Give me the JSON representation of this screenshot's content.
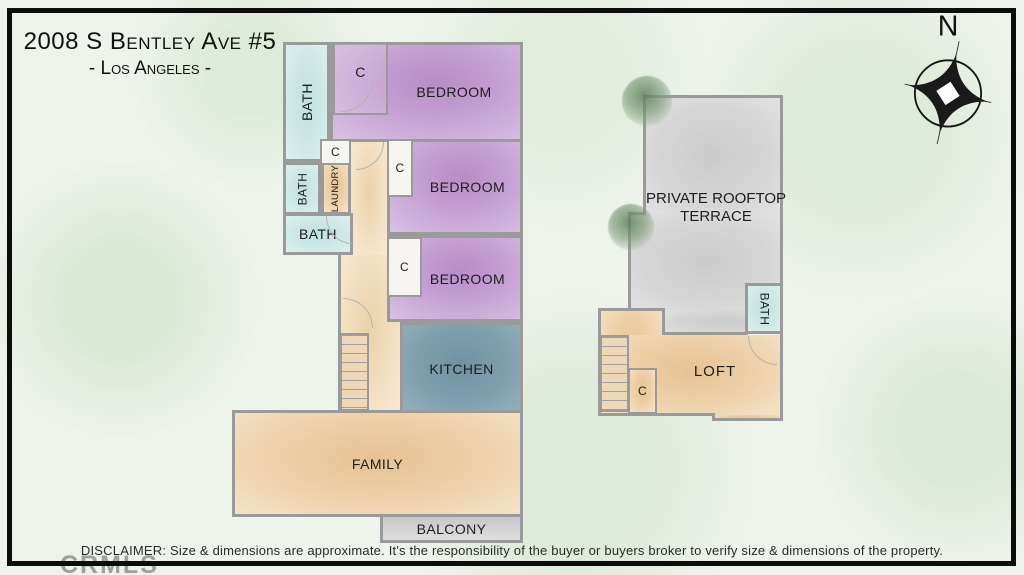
{
  "header": {
    "title": "2008 S Bentley Ave #5",
    "subtitle": "- Los Angeles -"
  },
  "compass": {
    "north_label": "N"
  },
  "plan_main": {
    "bath_top": "BATH",
    "closet_top": "C",
    "bedroom_1": "BEDROOM",
    "closet_hall": "C",
    "bath_mid": "BATH",
    "laundry": "LAUNDRY",
    "bedroom_2": "BEDROOM",
    "closet_bed2": "C",
    "bath_low": "BATH",
    "bedroom_3": "BEDROOM",
    "closet_bed3": "C",
    "kitchen": "KITCHEN",
    "family": "FAMILY",
    "balcony": "BALCONY"
  },
  "plan_upper": {
    "terrace": "PRIVATE ROOFTOP TERRACE",
    "bath": "BATH",
    "loft": "LOFT",
    "closet": "C"
  },
  "footer": {
    "disclaimer": "DISCLAIMER: Size & dimensions are approximate. It's the responsibility of the buyer or buyers broker to verify size & dimensions of the property."
  },
  "watermark": "CRMLS",
  "colors": {
    "bedroom": "#c7a4d4",
    "bath": "#c9e6e4",
    "living": "#ecca9e",
    "kitchen": "#7f9fae",
    "terrace": "#d6d6d6",
    "balcony": "#d8d8d8",
    "wall": "#9a9a9a",
    "frame": "#0d0d0d"
  }
}
